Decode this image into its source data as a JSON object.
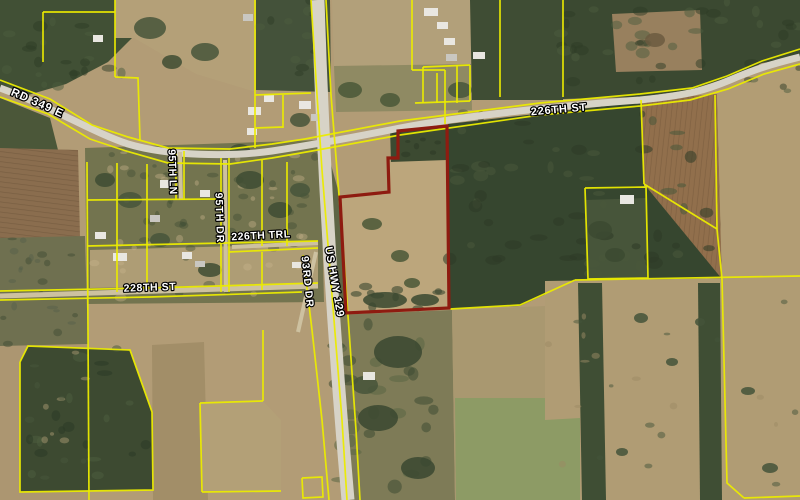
{
  "map": {
    "description": "Aerial parcel map with yellow parcel boundaries, road labels, and a subject parcel outlined in dark red east of US HWY 129 and south of 226th St",
    "canvas": {
      "width": 800,
      "height": 500
    },
    "colors": {
      "parcel_line": "#ebeb00",
      "highlight_outline": "#8e1b10",
      "label_fill": "#ffffff",
      "label_halo": "#000000",
      "road_paved": "#d7d3c7",
      "road_dirt": "#cdc1a0",
      "building": "#e9e7e1"
    },
    "labels": [
      {
        "id": "county-rd-349-e",
        "text": "COUNTY RD 349 E",
        "curve": "M8,94 C45,109 80,127 124,145",
        "font_size": 11.5,
        "letter_spacing": 0.8
      },
      {
        "id": "226th-st",
        "text": "226TH ST",
        "x": 559,
        "y": 110,
        "rotate": -5,
        "font_size": 11,
        "letter_spacing": 0.8
      },
      {
        "id": "95th-ln",
        "text": "95TH LN",
        "x": 172,
        "y": 172,
        "rotate": 88,
        "font_size": 10.5,
        "letter_spacing": 0.4
      },
      {
        "id": "95th-dr",
        "text": "95TH DR",
        "x": 219,
        "y": 218,
        "rotate": 88,
        "font_size": 10.5,
        "letter_spacing": 1.0
      },
      {
        "id": "226th-trl",
        "text": "226TH TRL",
        "x": 261,
        "y": 236,
        "rotate": -3,
        "font_size": 10.5,
        "letter_spacing": 0.5
      },
      {
        "id": "93rd-dr",
        "text": "93RD DR",
        "x": 307,
        "y": 282,
        "rotate": 84,
        "font_size": 10.5,
        "letter_spacing": 1.0
      },
      {
        "id": "us-hwy-129",
        "text": "US HWY 129",
        "x": 334,
        "y": 282,
        "rotate": 80,
        "font_size": 11,
        "letter_spacing": 0.6
      },
      {
        "id": "228th-st",
        "text": "228TH ST",
        "x": 150,
        "y": 288,
        "rotate": -2,
        "font_size": 10.5,
        "letter_spacing": 0.6
      }
    ],
    "highlight_parcel": {
      "stroke_width": 3.2,
      "points": [
        [
          398,
          131
        ],
        [
          447,
          126
        ],
        [
          449,
          308
        ],
        [
          346,
          313
        ],
        [
          340,
          197
        ],
        [
          389,
          192
        ],
        [
          388,
          158
        ],
        [
          398,
          158
        ]
      ]
    },
    "roads": [
      {
        "id": "county-rd-349-e-226th-st",
        "surface": "paved",
        "width": 7,
        "path": "M0,88 C50,106 92,132 128,144 C168,156 230,157 272,151 C305,146 335,141 400,128 C470,115 560,106 640,100 C690,95 706,90 730,80 C760,67 780,62 800,57"
      },
      {
        "id": "us-hwy-129",
        "surface": "paved",
        "width": 13,
        "path": "M318,0 C323,160 332,320 348,500"
      },
      {
        "id": "228th-st",
        "surface": "dirt",
        "width": 5,
        "path": "M0,296 L318,286"
      },
      {
        "id": "93rd-dr",
        "surface": "dirt",
        "width": 4,
        "path": "M316,252 L298,332"
      },
      {
        "id": "95th-ln",
        "surface": "dirt",
        "width": 4,
        "path": "M180,152 L181,200"
      },
      {
        "id": "95th-dr",
        "surface": "dirt",
        "width": 4,
        "path": "M225,160 L226,292"
      },
      {
        "id": "226th-trl",
        "surface": "dirt",
        "width": 4,
        "path": "M232,247 L318,243"
      }
    ],
    "parcel_lines": [
      {
        "points": [
          [
            0,
            80
          ],
          [
            50,
            99
          ],
          [
            92,
            125
          ],
          [
            128,
            137
          ],
          [
            168,
            148
          ],
          [
            230,
            149
          ],
          [
            272,
            144
          ],
          [
            305,
            139
          ],
          [
            400,
            121
          ],
          [
            540,
            103
          ],
          [
            640,
            94
          ],
          [
            692,
            88
          ],
          [
            727,
            76
          ],
          [
            762,
            61
          ],
          [
            800,
            49
          ]
        ]
      },
      {
        "points": [
          [
            0,
            97
          ],
          [
            48,
            114
          ],
          [
            90,
            139
          ],
          [
            126,
            151
          ],
          [
            168,
            163
          ],
          [
            230,
            164
          ],
          [
            272,
            158
          ],
          [
            312,
            151
          ],
          [
            400,
            135
          ],
          [
            540,
            115
          ],
          [
            640,
            106
          ],
          [
            690,
            100
          ],
          [
            728,
            89
          ],
          [
            764,
            74
          ],
          [
            800,
            64
          ]
        ]
      },
      {
        "points": [
          [
            311,
            0
          ],
          [
            317,
            95
          ],
          [
            322,
            170
          ],
          [
            328,
            245
          ],
          [
            334,
            320
          ],
          [
            342,
            420
          ],
          [
            347,
            500
          ]
        ]
      },
      {
        "points": [
          [
            326,
            0
          ],
          [
            331,
            95
          ],
          [
            337,
            170
          ],
          [
            343,
            245
          ],
          [
            349,
            330
          ],
          [
            356,
            430
          ],
          [
            360,
            500
          ]
        ]
      },
      {
        "points": [
          [
            303,
            255
          ],
          [
            312,
            330
          ],
          [
            322,
            420
          ],
          [
            329,
            500
          ]
        ]
      },
      {
        "points": [
          [
            263,
            330
          ],
          [
            263,
            401
          ]
        ]
      },
      {
        "points": [
          [
            0,
            291
          ],
          [
            150,
            288
          ],
          [
            318,
            283
          ]
        ]
      },
      {
        "points": [
          [
            0,
            300
          ],
          [
            150,
            297
          ],
          [
            302,
            292
          ]
        ]
      },
      {
        "points": [
          [
            115,
            0
          ],
          [
            115,
            77
          ]
        ]
      },
      {
        "points": [
          [
            43,
            12
          ],
          [
            115,
            12
          ]
        ]
      },
      {
        "points": [
          [
            43,
            12
          ],
          [
            43,
            62
          ]
        ]
      },
      {
        "points": [
          [
            115,
            77
          ],
          [
            138,
            78
          ],
          [
            140,
            140
          ]
        ]
      },
      {
        "points": [
          [
            255,
            0
          ],
          [
            255,
            148
          ]
        ]
      },
      {
        "points": [
          [
            255,
            128
          ],
          [
            283,
            127
          ]
        ]
      },
      {
        "points": [
          [
            283,
            95
          ],
          [
            283,
            128
          ]
        ]
      },
      {
        "points": [
          [
            255,
            95
          ],
          [
            311,
            93
          ]
        ]
      },
      {
        "points": [
          [
            87,
            162
          ],
          [
            89,
            500
          ]
        ]
      },
      {
        "points": [
          [
            117,
            163
          ],
          [
            117,
            292
          ]
        ]
      },
      {
        "points": [
          [
            147,
            164
          ],
          [
            147,
            292
          ]
        ]
      },
      {
        "points": [
          [
            176,
            151
          ],
          [
            176,
            200
          ]
        ]
      },
      {
        "points": [
          [
            184,
            151
          ],
          [
            184,
            200
          ]
        ]
      },
      {
        "points": [
          [
            221,
            158
          ],
          [
            221,
            292
          ]
        ]
      },
      {
        "points": [
          [
            229,
            158
          ],
          [
            229,
            292
          ]
        ]
      },
      {
        "points": [
          [
            262,
            160
          ],
          [
            262,
            246
          ]
        ]
      },
      {
        "points": [
          [
            287,
            162
          ],
          [
            287,
            246
          ]
        ]
      },
      {
        "points": [
          [
            87,
            200
          ],
          [
            221,
            199
          ]
        ]
      },
      {
        "points": [
          [
            87,
            246
          ],
          [
            318,
            241
          ]
        ]
      },
      {
        "points": [
          [
            229,
            252
          ],
          [
            318,
            248
          ]
        ]
      },
      {
        "points": [
          [
            262,
            252
          ],
          [
            262,
            290
          ]
        ]
      },
      {
        "points": [
          [
            20,
            362
          ],
          [
            28,
            346
          ],
          [
            130,
            350
          ],
          [
            152,
            412
          ],
          [
            153,
            490
          ],
          [
            20,
            492
          ],
          [
            20,
            362
          ]
        ]
      },
      {
        "points": [
          [
            200,
            403
          ],
          [
            263,
            401
          ]
        ]
      },
      {
        "points": [
          [
            200,
            403
          ],
          [
            202,
            492
          ]
        ]
      },
      {
        "points": [
          [
            202,
            492
          ],
          [
            281,
            491
          ]
        ]
      },
      {
        "points": [
          [
            302,
            478
          ],
          [
            322,
            477
          ],
          [
            323,
            497
          ],
          [
            303,
            498
          ],
          [
            302,
            478
          ]
        ]
      },
      {
        "points": [
          [
            412,
            0
          ],
          [
            412,
            70
          ]
        ]
      },
      {
        "points": [
          [
            412,
            70
          ],
          [
            445,
            70
          ]
        ]
      },
      {
        "points": [
          [
            445,
            70
          ],
          [
            445,
            124
          ]
        ]
      },
      {
        "points": [
          [
            500,
            0
          ],
          [
            500,
            97
          ]
        ]
      },
      {
        "points": [
          [
            563,
            0
          ],
          [
            563,
            97
          ]
        ]
      },
      {
        "points": [
          [
            423,
            67
          ],
          [
            470,
            65
          ]
        ]
      },
      {
        "points": [
          [
            423,
            67
          ],
          [
            423,
            103
          ]
        ]
      },
      {
        "points": [
          [
            437,
            73
          ],
          [
            437,
            103
          ]
        ]
      },
      {
        "points": [
          [
            457,
            65
          ],
          [
            457,
            103
          ]
        ]
      },
      {
        "points": [
          [
            415,
            103
          ],
          [
            470,
            101
          ]
        ]
      },
      {
        "points": [
          [
            470,
            65
          ],
          [
            470,
            101
          ]
        ]
      },
      {
        "points": [
          [
            641,
            100
          ],
          [
            644,
            184
          ]
        ]
      },
      {
        "points": [
          [
            644,
            184
          ],
          [
            717,
            229
          ]
        ]
      },
      {
        "points": [
          [
            715,
            95
          ],
          [
            717,
            229
          ]
        ]
      },
      {
        "points": [
          [
            717,
            229
          ],
          [
            722,
            279
          ]
        ]
      },
      {
        "points": [
          [
            575,
            280
          ],
          [
            800,
            276
          ]
        ]
      },
      {
        "points": [
          [
            450,
            309
          ],
          [
            520,
            305
          ],
          [
            575,
            280
          ]
        ]
      },
      {
        "points": [
          [
            722,
            279
          ],
          [
            727,
            483
          ],
          [
            744,
            498
          ]
        ]
      },
      {
        "points": [
          [
            744,
            498
          ],
          [
            800,
            496
          ]
        ]
      },
      {
        "points": [
          [
            585,
            188
          ],
          [
            646,
            187
          ],
          [
            648,
            278
          ],
          [
            588,
            279
          ],
          [
            585,
            188
          ]
        ]
      }
    ],
    "buildings": [
      [
        248,
        107,
        13,
        8
      ],
      [
        264,
        95,
        10,
        7
      ],
      [
        299,
        101,
        12,
        8
      ],
      [
        311,
        114,
        9,
        7
      ],
      [
        247,
        128,
        10,
        7
      ],
      [
        160,
        180,
        12,
        8
      ],
      [
        200,
        190,
        10,
        7
      ],
      [
        150,
        215,
        10,
        7
      ],
      [
        182,
        252,
        10,
        7
      ],
      [
        95,
        232,
        11,
        7
      ],
      [
        113,
        253,
        14,
        8
      ],
      [
        195,
        261,
        10,
        6
      ],
      [
        424,
        8,
        14,
        8
      ],
      [
        437,
        22,
        11,
        7
      ],
      [
        444,
        38,
        11,
        7
      ],
      [
        446,
        54,
        11,
        7
      ],
      [
        473,
        52,
        12,
        7
      ],
      [
        620,
        195,
        14,
        9
      ],
      [
        93,
        35,
        10,
        7
      ],
      [
        243,
        14,
        10,
        7
      ],
      [
        363,
        372,
        12,
        8
      ],
      [
        292,
        262,
        9,
        6
      ]
    ]
  }
}
